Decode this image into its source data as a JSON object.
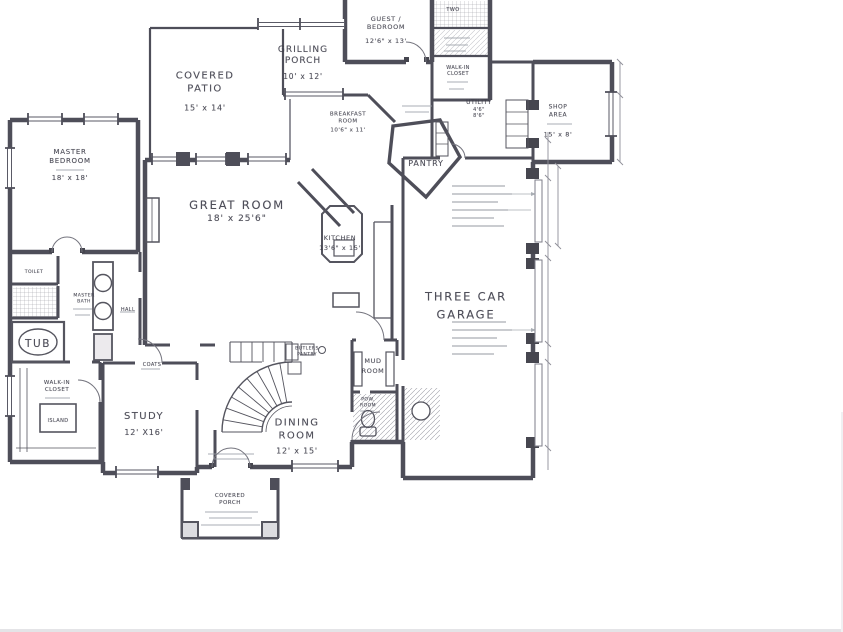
{
  "rooms": {
    "covered_patio": {
      "line1": "COVERED",
      "line2": "PATIO",
      "dims": "15' x 14'"
    },
    "grilling_porch": {
      "line1": "GRILLING",
      "line2": "PORCH",
      "dims": "10' x 12'"
    },
    "guest_bedroom": {
      "line1": "GUEST /",
      "line2": "BEDROOM",
      "dims": "12'6\" x 13'"
    },
    "breakfast_room": {
      "line1": "BREAKFAST",
      "line2": "ROOM",
      "dims": "10'6\" x 11'"
    },
    "master_bedroom": {
      "line1": "MASTER",
      "line2": "BEDROOM",
      "dims": "18' x 18'"
    },
    "great_room": {
      "name": "GREAT ROOM",
      "dims": "18' x 25'6\""
    },
    "pantry": {
      "name": "PANTRY"
    },
    "kitchen": {
      "name": "KITCHEN",
      "dims": "13'6\" x 15'"
    },
    "garage": {
      "line1": "THREE CAR",
      "line2": "GARAGE"
    },
    "shop": {
      "line1": "SHOP",
      "line2": "AREA",
      "dims": "15' x 8'"
    },
    "utility": {
      "name": "UTILITY",
      "dim1": "4'6\"",
      "dim2": "8'6\""
    },
    "closet_upper": {
      "line1": "WALK-IN",
      "line2": "CLOSET"
    },
    "bath_two": {
      "name": "TWO"
    },
    "tub": {
      "name": "TUB"
    },
    "master_bath": {
      "line1": "MASTER",
      "line2": "BATH"
    },
    "toilet": {
      "name": "TOILET"
    },
    "hall": {
      "name": "HALL"
    },
    "closet_master": {
      "line1": "WALK-IN",
      "line2": "CLOSET"
    },
    "island": {
      "name": "ISLAND"
    },
    "coats": {
      "name": "COATS"
    },
    "study": {
      "name": "STUDY",
      "dims": "12' X16'"
    },
    "dining": {
      "line1": "DINING",
      "line2": "ROOM",
      "dims": "12' x 15'"
    },
    "butlers": {
      "line1": "BUTLERS",
      "line2": "PANTRY"
    },
    "mud": {
      "line1": "MUD",
      "line2": "ROOM"
    },
    "powder": {
      "line1": "POW.",
      "line2": "ROOM"
    },
    "porch": {
      "line1": "COVERED",
      "line2": "PORCH"
    }
  },
  "colors": {
    "ink": "#4e4e59",
    "faint": "#9ba0a8",
    "paper": "#ffffff"
  }
}
